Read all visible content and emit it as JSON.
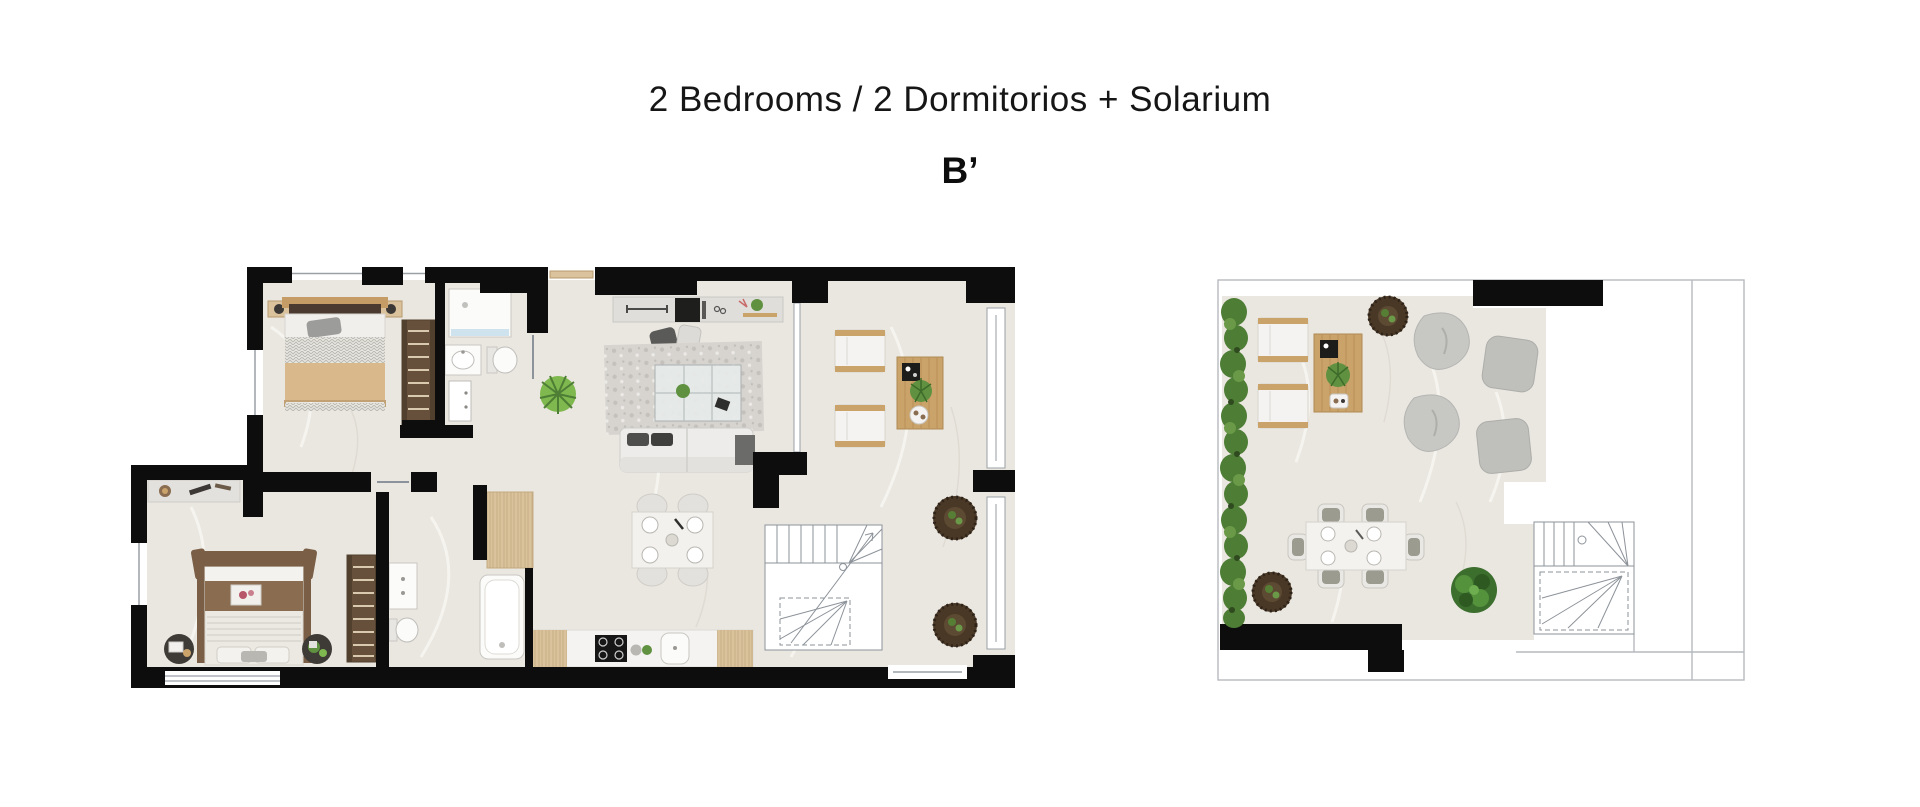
{
  "header": {
    "title": "2 Bedrooms / 2 Dormitorios + Solarium",
    "unit_label": "B’"
  },
  "colors": {
    "wall_black": "#0d0d0d",
    "floor_tile": "#eae7e1",
    "tile_vein_light": "#f7f5f0",
    "tile_vein_dark": "#dcd8d0",
    "wood_light": "#d9c29c",
    "wood_mid": "#c9a36a",
    "wardrobe_brown": "#66503c",
    "wardrobe_rung": "#d9c9ae",
    "bed_blanket_beige": "#d9b98c",
    "bed2_frame_brown": "#7a5f46",
    "bed2_blanket_brown": "#8a6d50",
    "sofa_white": "#edecea",
    "rug_marble_gray": "#d7d4d0",
    "pouf_gray": "#c6c6c3",
    "planter_brown": "#4a3826",
    "plant_green": "#5f9140",
    "hedge_green": "#4e7d35",
    "shower_glass_blue": "#cfe3ee",
    "outline_gray": "#9aa0a6",
    "fixture_white": "#fbfbfa"
  },
  "floor_plans": {
    "main": {
      "name": "main-floor-plan",
      "items": [
        "double-bed",
        "nightstand",
        "wardrobe",
        "shower",
        "toilet",
        "washbasin",
        "bathroom-door",
        "entry-door",
        "tv-sideboard",
        "armchair",
        "pouf",
        "marble-rug",
        "coffee-table",
        "sofa",
        "side-table",
        "dining-table-4-chairs",
        "floor-plant",
        "kitchen-counter",
        "hob",
        "kitchen-sink",
        "tall-wood-cabinet",
        "bathtub",
        "vanity",
        "toilet-2",
        "wardrobe-2",
        "desk",
        "double-bed-2",
        "bedside-round-table",
        "staircase",
        "terrace-lounge-chair",
        "terrace-wood-table",
        "round-planter",
        "glass-balustrade",
        "sliding-glass-door",
        "window"
      ]
    },
    "solarium": {
      "name": "solarium-plan",
      "items": [
        "parapet-outline",
        "hedge-planter",
        "sun-lounger",
        "wood-side-table",
        "round-planter",
        "bean-bag",
        "lounge-pouf",
        "dining-table-6-chairs",
        "dining-chair",
        "garden-bush",
        "staircase",
        "roof-wall"
      ]
    }
  }
}
